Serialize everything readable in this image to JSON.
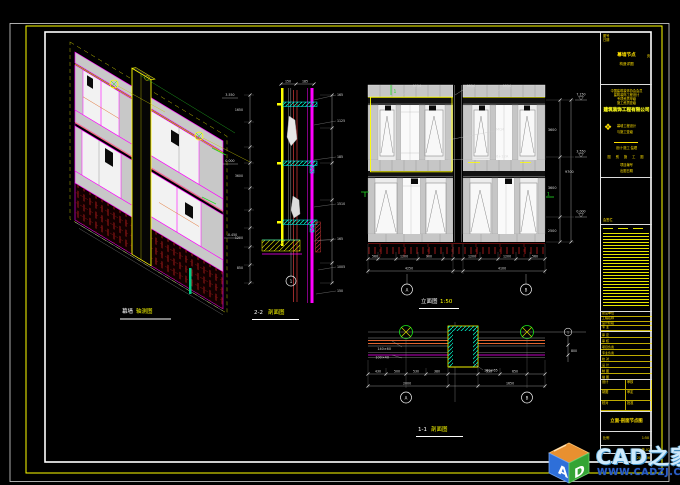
{
  "sheet": {
    "background": "#000000",
    "frame_colors": {
      "outer_white": "#d8d8d8",
      "yellow_frame": "#ffff00",
      "inner_white": "#ffffff"
    }
  },
  "iso": {
    "label_white": "幕墙",
    "label_yellow": "轴测图"
  },
  "sec2": {
    "top_dims": [
      "150",
      "185"
    ],
    "left_levels": [
      "3.550",
      "0.000",
      "-0.450"
    ],
    "left_dims": [
      "1650",
      "3600",
      "1200",
      "850"
    ],
    "right_notes": [
      "165",
      "1125",
      "185",
      "1510",
      "165",
      "1005",
      "150"
    ],
    "bubble": "1",
    "label_white": "2-2",
    "label_yellow": "剖面图"
  },
  "elevation": {
    "top_notes": [
      "MQ4",
      "MQ4",
      "MQ4"
    ],
    "mid_notes": [
      "MQ4",
      "6+12A"
    ],
    "levels": [
      "7.150",
      "3.550",
      "0.000"
    ],
    "right_dims": [
      "3600",
      "3600",
      "2500"
    ],
    "total_height": "9700",
    "bottom_dims_1": [
      "560",
      "1200",
      "900",
      "1200",
      "1200",
      "560"
    ],
    "bottom_dims_2": [
      "4250",
      "4100"
    ],
    "axis_letters": [
      "A",
      "B"
    ],
    "marks": [
      "1",
      "1"
    ],
    "label_white": "立面图",
    "label_yellow": "1:50"
  },
  "sec1": {
    "dims_1": [
      "430",
      "500",
      "530",
      "380",
      "530",
      "650"
    ],
    "dims_2": [
      "2000",
      "1650"
    ],
    "side_dim": "800",
    "left_notes": [
      "140×60",
      "100×40"
    ],
    "col_note": "180×65",
    "side_axis": "1",
    "axis_letters": [
      "A",
      "B"
    ],
    "label_white": "1-1",
    "label_yellow": "剖面图"
  },
  "titleblock": {
    "box_a": {
      "corner1": "图号",
      "corner2": "日期",
      "line1": "幕墙节点",
      "line1_side": "页",
      "line2": "构造详图"
    },
    "box_b": {
      "cert1": "中国建筑装饰协会会员",
      "cert2": "建筑装饰工程设计",
      "cert3": "专项资质甲级",
      "cert4": "施工资质壹级",
      "company": "建筑装饰工程有限公司",
      "logo": "❖",
      "sub1": "幕墙工程设计",
      "sub2": "与施工壹级",
      "tagline": "设计·施工·监理",
      "spaced": "图 别 施 工 图",
      "foot1": "项目编号",
      "foot2": "出图日期"
    },
    "box_c": {
      "label": "会签栏"
    },
    "fields": [
      "建设单位",
      "工程名称",
      "设计阶段",
      "专 业",
      "日 期"
    ],
    "staff": [
      "审 定",
      "审 核",
      "项目负责",
      "专业负责",
      "校 对",
      "设 计",
      "制 图",
      "描 图"
    ],
    "table": [
      [
        "设计",
        "审核"
      ],
      [
        "制图",
        "审定"
      ],
      [
        "校对",
        "批准"
      ]
    ],
    "sheet_title": "立面·剖面节点图",
    "scale_label": "比例",
    "scale_value": "1:50",
    "fig_no": "施-02",
    "date": "2008.06"
  },
  "watermark": {
    "cube_letters": [
      "A",
      "D"
    ],
    "title": "CAD之家",
    "url": "WWW.CADZJ.COM",
    "colors": {
      "title": "#cfeafb",
      "url": "#2b5fc7",
      "cube_orange": "#e89030",
      "cube_green": "#35a435",
      "cube_blue": "#2e6fd9"
    }
  }
}
